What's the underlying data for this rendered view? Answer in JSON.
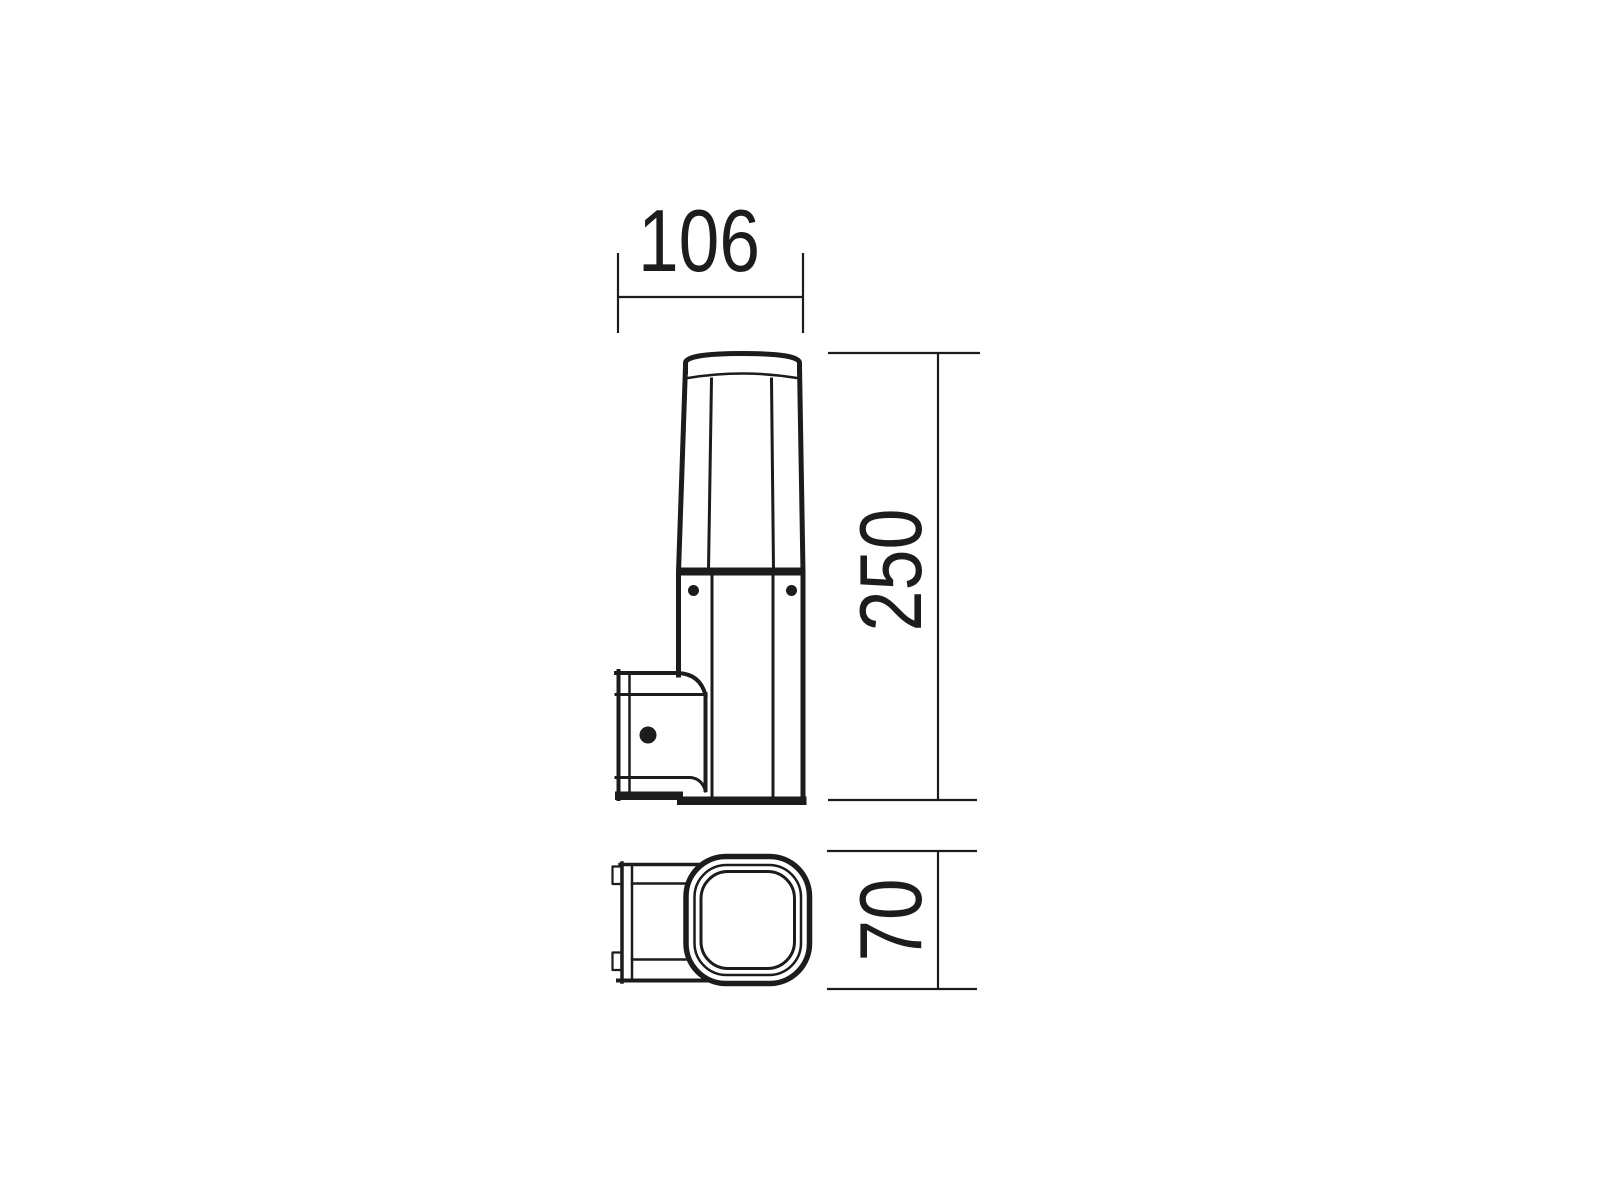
{
  "page": {
    "background_color": "#ffffff"
  },
  "drawing": {
    "line_color": "#1c1c1c",
    "dimensions": {
      "width": "106",
      "height": "250",
      "depth": "70"
    }
  }
}
